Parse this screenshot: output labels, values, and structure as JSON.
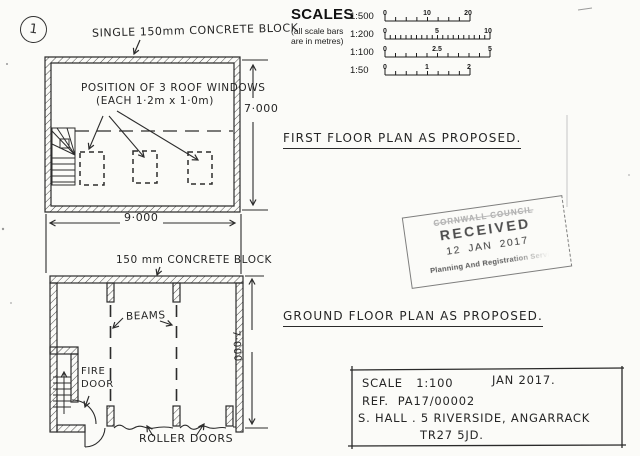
{
  "page": {
    "sheet_number": "1"
  },
  "first_floor": {
    "wall_label": "SINGLE 150mm CONCRETE BLOCK",
    "roof_windows_note_line1": "POSITION OF 3 ROOF WINDOWS",
    "roof_windows_note_line2": "(EACH 1·2m x 1·0m)",
    "height_dim": "7·000",
    "width_dim": "9·000",
    "title": "FIRST FLOOR PLAN AS PROPOSED."
  },
  "scales": {
    "heading": "SCALES",
    "note_line1": "(all scale bars",
    "note_line2": "are in metres)",
    "rows": [
      {
        "ratio": "1:500",
        "start": "0",
        "mid": "10",
        "end": "20"
      },
      {
        "ratio": "1:200",
        "start": "0",
        "mid": "5",
        "end": "10"
      },
      {
        "ratio": "1:100",
        "start": "0",
        "mid": "2.5",
        "end": "5"
      },
      {
        "ratio": "1:50",
        "start": "0",
        "mid": "1",
        "end": "2"
      }
    ]
  },
  "stamp": {
    "council": "CORNWALL COUNCIL",
    "received": "RECEIVED",
    "date": "12 JAN 2017",
    "department": "Planning And Registration Servi"
  },
  "ground_floor": {
    "wall_label": "150 mm CONCRETE BLOCK",
    "beams_label": "BEAMS",
    "fire_door_label_line1": "FIRE",
    "fire_door_label_line2": "DOOR",
    "height_dim": "7·000",
    "roller_doors_label": "ROLLER DOORS",
    "title": "GROUND FLOOR PLAN AS PROPOSED."
  },
  "title_block": {
    "scale": "SCALE   1:100",
    "date": "JAN 2017.",
    "reference": "REF.  PA17/00002",
    "address_line1": "S. HALL . 5 RIVERSIDE, ANGARRACK",
    "address_line2": "TR27 5JD."
  }
}
